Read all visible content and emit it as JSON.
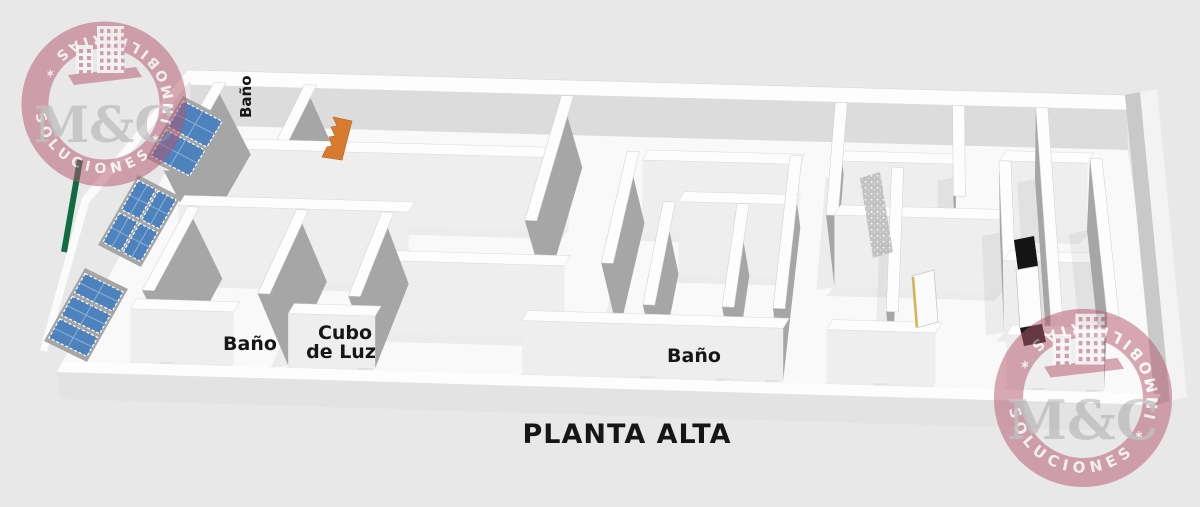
{
  "title": "PLANTA ALTA",
  "labels": {
    "bano_top": "Baño",
    "bano_lower_left": "Baño",
    "cubo_line1": "Cubo",
    "cubo_line2": "de Luz",
    "bano_center": "Baño"
  },
  "watermark": {
    "ring_text": "SOLUCIONES * INMOBILIARIAS *",
    "monogram": "M&C"
  },
  "colors": {
    "background": "#e8e8e8",
    "floor": "#f9f9f9",
    "wall_top": "#fdfdfd",
    "wall_face": "#eeeeee",
    "wall_side": "#a6a6a6",
    "fascia": "#e3e3e3",
    "far_face": "#dcdcdc",
    "right_face": "#c9c9c9",
    "window_blue": "#4e82bc",
    "window_grid": "#8ab0d8",
    "stairs_orange": "#d97b2e",
    "edge_green": "#116b46",
    "ink": "#161616",
    "watermark_pink": "#b4556e",
    "monogram_gray": "#9b9b9b"
  }
}
